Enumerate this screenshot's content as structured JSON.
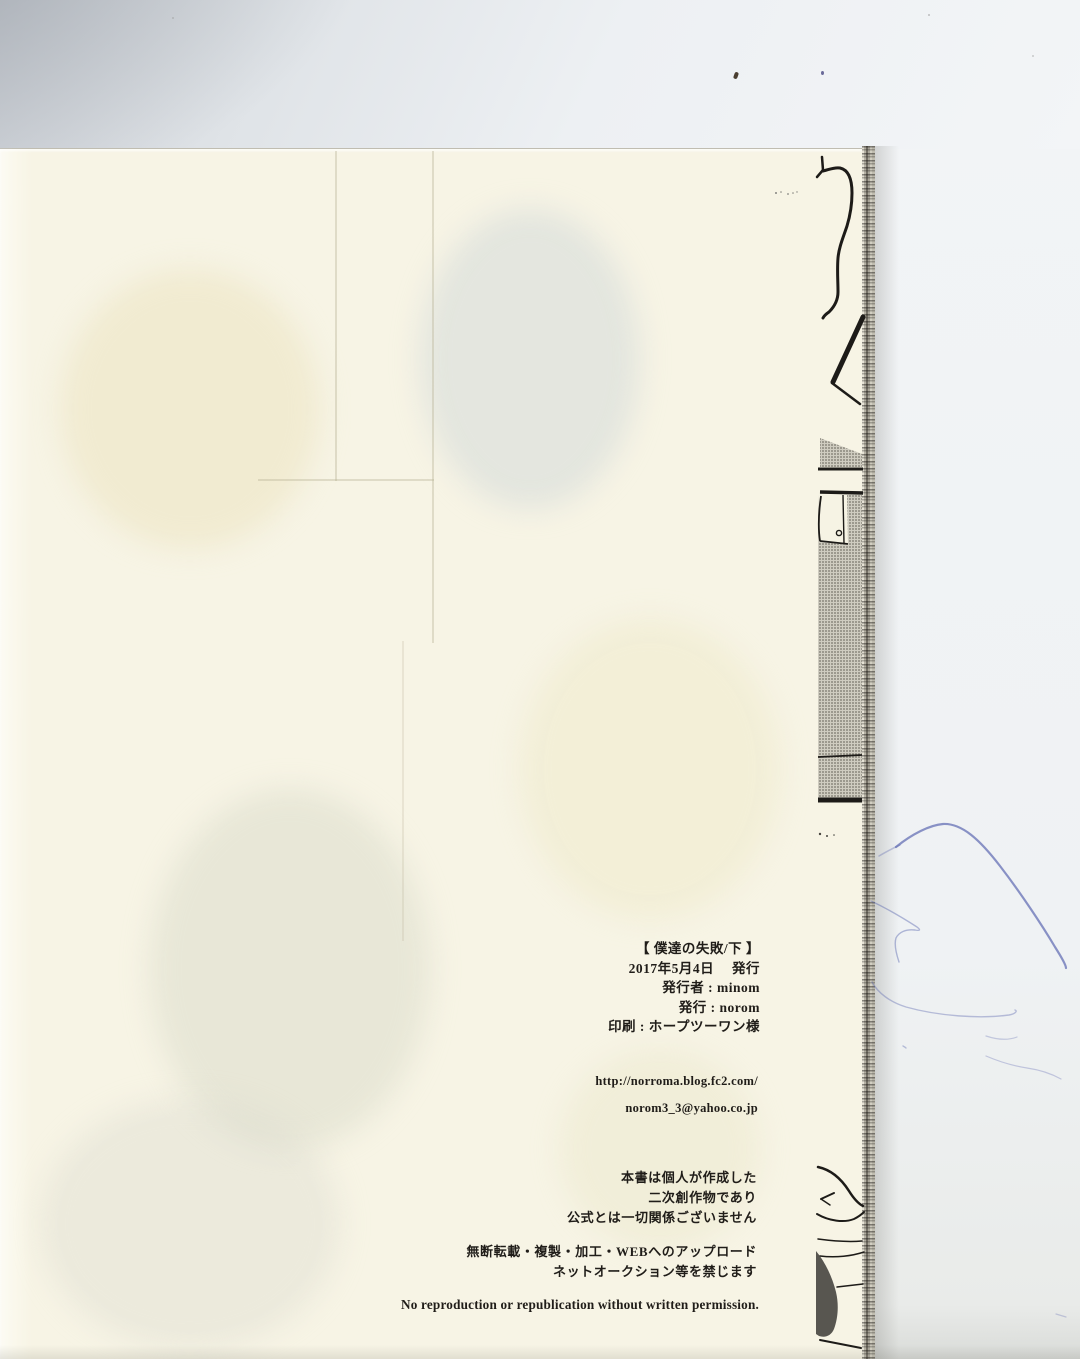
{
  "colophon": {
    "lines": [
      "【 僕達の失敗/下 】",
      "2017年5月4日　 発行",
      "発行者 : minom",
      "発行 : norom",
      "印刷 : ホープツーワン様"
    ]
  },
  "contact": {
    "url": "http://norroma.blog.fc2.com/",
    "email": "norom3_3@yahoo.co.jp"
  },
  "disclaimer": {
    "group1": [
      "本書は個人が作成した",
      "二次創作物であり",
      "公式とは一切関係ございません"
    ],
    "group2": [
      "無断転載・複製・加工・WEBへのアップロード",
      "ネットオークション等を禁じます"
    ]
  },
  "english_notice": "No reproduction or republication without written permission.",
  "colors": {
    "paper": "#f7f4e5",
    "scanner_bed": "#eff2f4",
    "ink": "#201d19",
    "pen_blue": "#5c68b0",
    "screentone": "#77746a"
  }
}
